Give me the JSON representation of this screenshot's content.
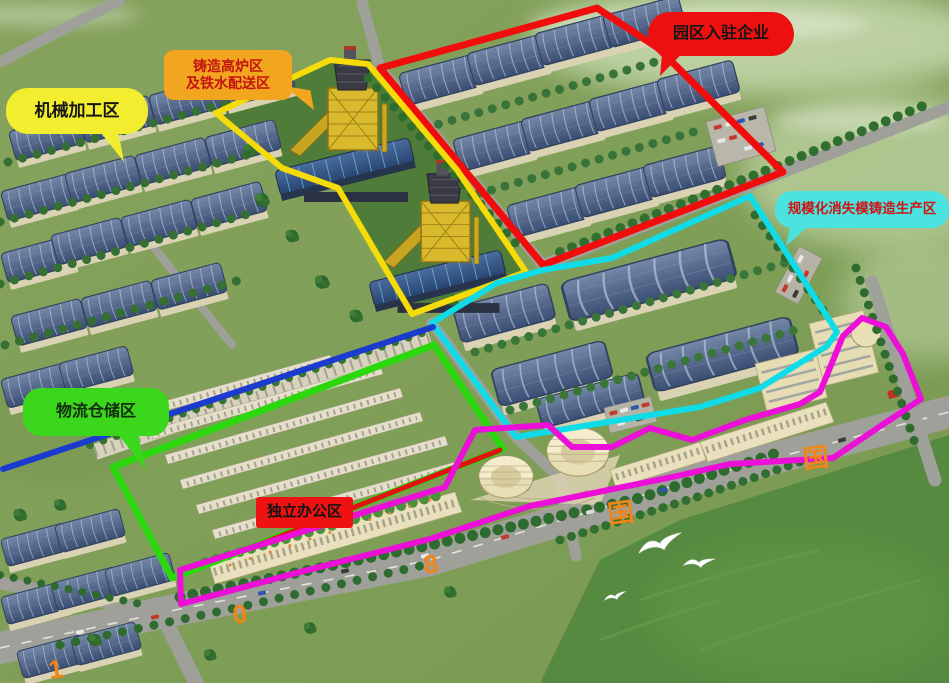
{
  "labels": {
    "machining": {
      "text": "机械加工区",
      "bg": "#f2ee2f",
      "text_color": "#161616"
    },
    "furnace": {
      "line1": "铸造高炉区",
      "line2": "及铁水配送区",
      "bg": "#f2a51e",
      "text_color": "#c31311"
    },
    "enterprises": {
      "text": "园区入驻企业",
      "bg": "#ee1010",
      "text_color": "#151515"
    },
    "lost_foam": {
      "text": "规模化消失模铸造生产区",
      "bg": "#4ae3e0",
      "text_color": "#d01313"
    },
    "logistics": {
      "text": "物流仓储区",
      "bg": "#3bd71d",
      "text_color": "#142c10"
    },
    "office": {
      "text": "独立办公区",
      "bg": "#ee1212",
      "text_color": "#141414"
    }
  },
  "outline_colors": {
    "red": "#f20d0d",
    "yellow": "#f5dc08",
    "cyan": "#10dce8",
    "blue": "#1b3bcf",
    "green": "#2ad80d",
    "magenta": "#ec0fd7",
    "office_line": "#e21212"
  },
  "watermarks": {
    "color": "#f28418",
    "items": [
      {
        "text": "1"
      },
      {
        "text": "0"
      },
      {
        "text": "8"
      },
      {
        "text": "国"
      },
      {
        "text": "国"
      }
    ]
  }
}
